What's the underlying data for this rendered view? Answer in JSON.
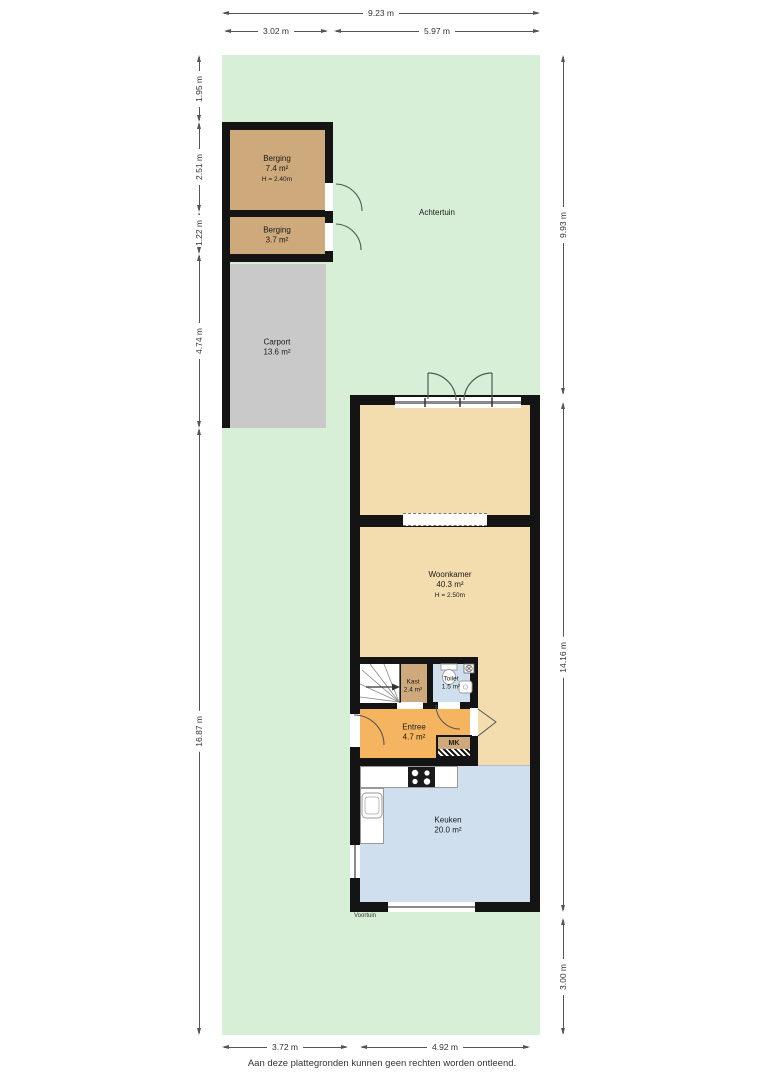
{
  "garden": {
    "back_label": "Achtertuin",
    "front_label": "Voortuin"
  },
  "rooms": {
    "berging1": {
      "name": "Berging",
      "area": "7.4 m²",
      "height": "H = 2.40m"
    },
    "berging2": {
      "name": "Berging",
      "area": "3.7 m²"
    },
    "carport": {
      "name": "Carport",
      "area": "13.6 m²"
    },
    "woonkamer": {
      "name": "Woonkamer",
      "area": "40.3 m²",
      "height": "H = 2.50m"
    },
    "kast": {
      "name": "Kast",
      "area": "2.4 m²"
    },
    "toilet": {
      "name": "Toilet",
      "area": "1.5 m²"
    },
    "entree": {
      "name": "Entree",
      "area": "4.7 m²"
    },
    "meterkast": {
      "name": "MK"
    },
    "keuken": {
      "name": "Keuken",
      "area": "20.0 m²"
    }
  },
  "dimensions": {
    "top_total": "9.23 m",
    "top_left": "3.02 m",
    "top_right": "5.97 m",
    "left_1": "1.95 m",
    "left_2": "2.51 m",
    "left_3": "1.22 m",
    "left_4": "4.74 m",
    "left_5": "16.87 m",
    "right_1": "9.93 m",
    "right_2": "14.16 m",
    "right_3": "3.00 m",
    "bottom_left": "3.72 m",
    "bottom_right": "4.92 m"
  },
  "footer": {
    "disclaimer": "Aan deze plattegronden kunnen geen rechten worden ontleend."
  },
  "colors": {
    "garden": "#d6efd6",
    "floor_tan": "#f3dcae",
    "floor_tan_dark": "#cda97c",
    "carport_gray": "#c9c9c9",
    "entree_orange": "#f5b45f",
    "wet_blue": "#cfdfee",
    "wall": "#141414"
  }
}
